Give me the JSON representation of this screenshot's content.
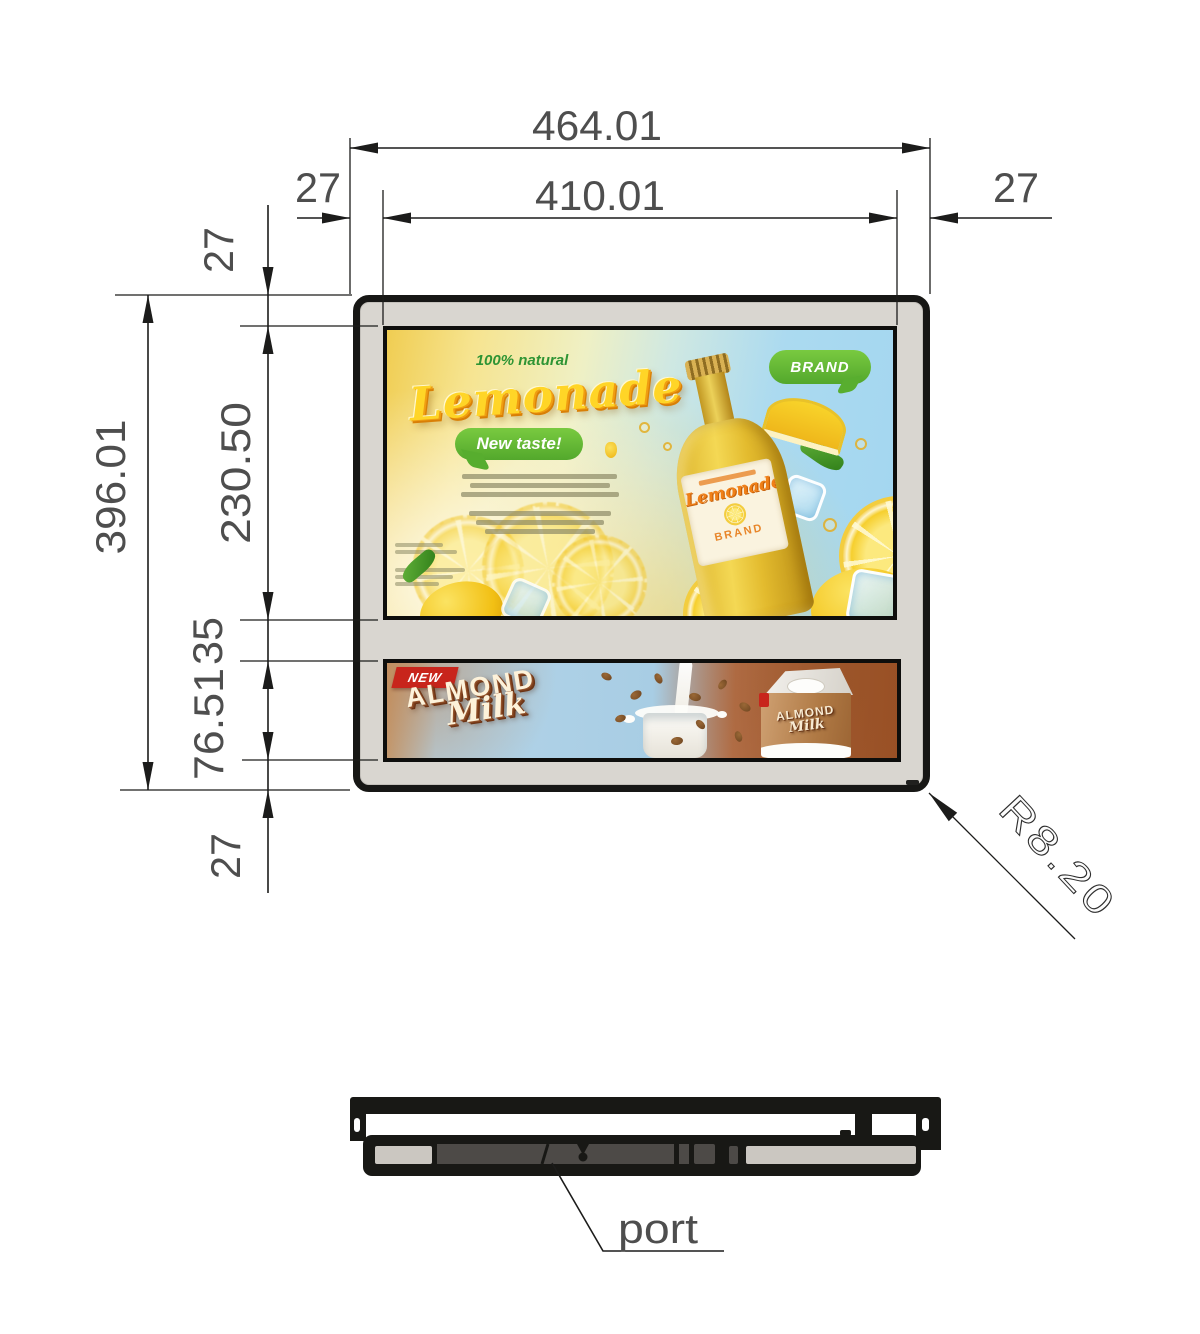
{
  "dimensions": {
    "top_width_outer": "464.01",
    "top_width_inner": "410.01",
    "top_margin_left": "27",
    "top_margin_right": "27",
    "left_margin_top": "27",
    "left_height_outer": "396.01",
    "left_screen1_height": "230.50",
    "left_gap": "35",
    "left_screen2_height": "76.51",
    "left_margin_bottom": "27",
    "corner_radius": "R8.20",
    "port_label": "port"
  },
  "lemonade_ad": {
    "tagline": "100% natural",
    "title": "Lemonade",
    "bubble": "New taste!",
    "brand_bubble": "BRAND",
    "bottle_label_title": "Lemonade",
    "bottle_label_brand": "BRAND"
  },
  "almond_ad": {
    "badge": "NEW",
    "word1": "ALMOND",
    "word2": "Milk",
    "carton_word1": "ALMOND",
    "carton_word2": "Milk"
  },
  "colors": {
    "dim-line": "#1c1c1b",
    "dim-text": "#4e4e4e",
    "frame": "#171715",
    "bezel": "#d9d6d0",
    "lemon-green": "#2e9434",
    "bubble-green": "#63bb35",
    "lemonade-yellow": "#ffd527",
    "almond-red": "#c8251c",
    "almond-cream": "#fdf2da"
  }
}
